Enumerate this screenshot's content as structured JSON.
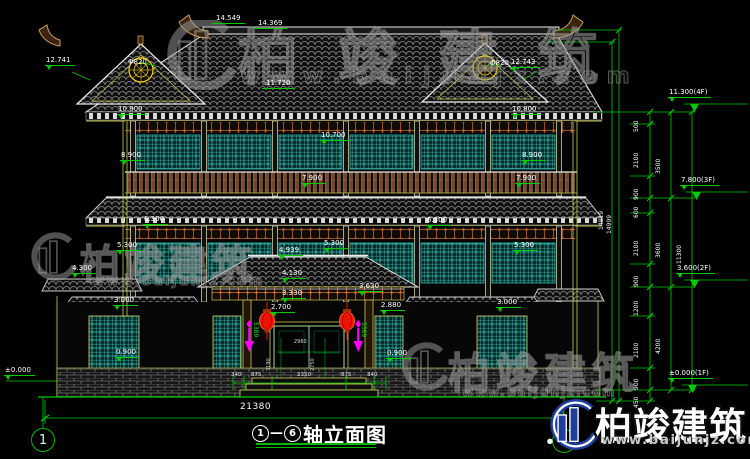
{
  "drawing": {
    "title": {
      "axis_from": "1",
      "axis_to": "6",
      "dash": "—",
      "label": "轴立面图"
    },
    "axis_bubbles": {
      "left": "1",
      "right": "6"
    },
    "elevations": {
      "e14549": "14.549",
      "e14369": "14.369",
      "e12741": "12.741",
      "e12743": "12.743",
      "e11720": "11.720",
      "phi820": "Φ820",
      "e10800": "10.800",
      "e10700": "10.700",
      "e8900": "8.900",
      "e7900": "7.900",
      "e6300": "6.300",
      "e5300": "5.300",
      "e4939": "4.939",
      "e4300": "4.300",
      "e4130": "4.130",
      "e3630": "3.630",
      "e3330": "3.330",
      "e3000": "3.000",
      "e2880": "2.880",
      "e2700": "2.700",
      "e0900": "0.900",
      "zero": "±0.000"
    },
    "levels": {
      "f4": "11.300(4F)",
      "f3": "7.800(3F)",
      "f2": "3.600(2F)",
      "f1": "±0.000(1F)"
    },
    "vchain": {
      "small": [
        "500",
        "2100",
        "900",
        "600",
        "2100",
        "900",
        "1200",
        "2100",
        "900",
        "450"
      ],
      "mid": [
        "3500",
        "3600",
        "4200"
      ],
      "outer": "11300",
      "totals": [
        "14819",
        "14999"
      ]
    },
    "hchain": {
      "segments": [
        "340",
        "875",
        "2350",
        "875",
        "340"
      ],
      "total": "21380"
    },
    "door_dims": {
      "width": "2960",
      "left_height": "3190",
      "right_height": "2750"
    },
    "misc_vertical": "5389"
  },
  "watermark": {
    "name": "柏竣建筑",
    "url": "www.baijunjz.com"
  },
  "brand": {
    "name": "柏竣建筑",
    "url": "www.baijunjz.com"
  },
  "colors": {
    "cad_green": "#00cc00",
    "cad_yellow": "#caca50",
    "teal": "#3ec9bd",
    "wood": "#8a5a2b",
    "lantern_red": "#ee1500",
    "magenta": "#ff00ff",
    "brand_blue": "#1d3f9a"
  }
}
